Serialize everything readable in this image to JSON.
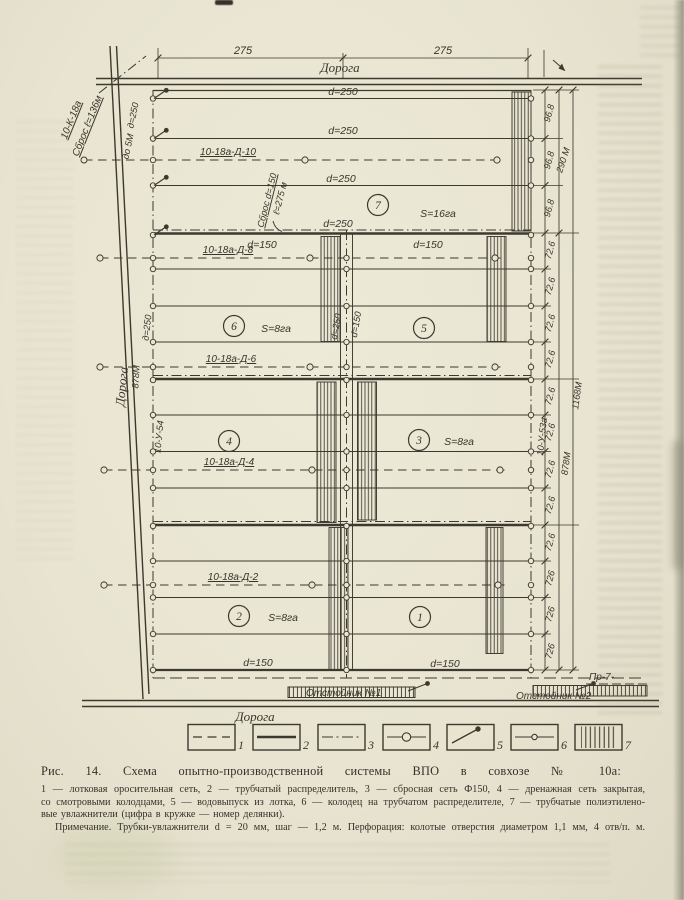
{
  "figure": {
    "heading": "Рис. 14. Схема опытно-производственной системы ВПО в совхозе № 10а:",
    "caption_lines": [
      "1 — лотковая оросительная сеть, 2 — трубчатый распределитель, 3 — сбросная сеть Ф150, 4 — дренажная сеть закрытая,",
      "со смотровыми колодцами, 5 — водовыпуск из лотка, 6 — колодец на трубчатом распределителе, 7 — трубчатые полиэтилено-",
      "вые увлажнители (цифра в кружке — номер делянки).",
      "Примечание. Трубки-увлажнители d = 20 мм, шаг — 1,2 м. Перфорация: колотые отверстия диаметром 1,1 мм, 4 отв/п. м."
    ]
  },
  "diagram": {
    "roads": {
      "top": "Дорога",
      "left": "Дорога",
      "bottom": "Дорога",
      "left_length": "878М"
    },
    "top_dims": {
      "left": "275",
      "right": "275"
    },
    "inlet": {
      "code": "10-К-18а",
      "discharge": "Сброс ℓ=136м",
      "depth": "до 5М"
    },
    "discharge_mid": {
      "line1": "Сброс d=150",
      "line2": "ℓ=275 м"
    },
    "pipes": {
      "d250": "d=250",
      "d150": "d=150",
      "d250_cyr": "д=250"
    },
    "drains": {
      "d10": "10-18а-Д-10",
      "d8": "10-18а-Д-8",
      "d6": "10-18а-Д-6",
      "d4": "10-18а-Д-4",
      "d2": "10-18а-Д-2"
    },
    "risers": {
      "left": "10-У-54",
      "right": "10-У-53а"
    },
    "sections": {
      "s7": {
        "num": "7",
        "area": "S=16га"
      },
      "s6": {
        "num": "6",
        "area": "S=8га"
      },
      "s5": {
        "num": "5"
      },
      "s4": {
        "num": "4"
      },
      "s3": {
        "num": "3",
        "area": "S=8га"
      },
      "s2": {
        "num": "2",
        "area": "S=8га"
      },
      "s1": {
        "num": "1"
      }
    },
    "dims_right": {
      "seg96": [
        "96.8",
        "96.8",
        "96.8"
      ],
      "seg72": [
        "72.6",
        "72.6",
        "72.6",
        "72.6",
        "72.6",
        "72.6",
        "72.6",
        "72.6",
        "72.6",
        "726",
        "726",
        "726"
      ],
      "total290": "290 М",
      "total878": "878М",
      "total1168": "1168М"
    },
    "sumps": {
      "n1": "Отстойник №1",
      "n2": "Отстойник №2"
    },
    "outlet_label": "Пр-7-"
  },
  "legend": {
    "items": [
      "1",
      "2",
      "3",
      "4",
      "5",
      "6",
      "7"
    ]
  }
}
